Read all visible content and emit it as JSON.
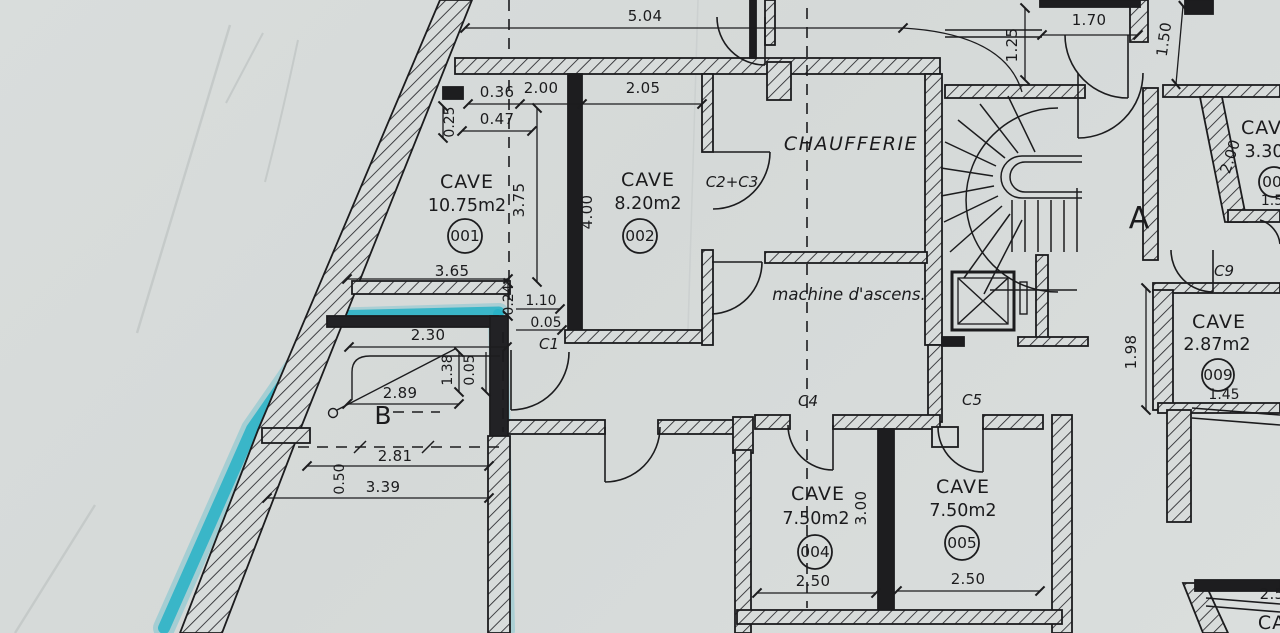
{
  "colors": {
    "paper": "#d7dbda",
    "ink": "#1c1c1e",
    "highlighter": "#27b1c6"
  },
  "rooms": [
    {
      "name": "CAVE",
      "area": "10.75m2",
      "number": "001"
    },
    {
      "name": "CAVE",
      "area": "8.20m2",
      "number": "002"
    },
    {
      "name": "CAVE",
      "area": "7.50m2",
      "number": "004"
    },
    {
      "name": "CAVE",
      "area": "7.50m2",
      "number": "005"
    },
    {
      "name": "CAVE",
      "area": "2.87m2",
      "number": "009"
    },
    {
      "name": "CAVE",
      "area": "3.30",
      "number": "00"
    }
  ],
  "areas": {
    "chaufferie": "CHAUFFERIE",
    "machine_room": "machine d'ascens.",
    "zone_a": "A",
    "zone_b": "B"
  },
  "doors": {
    "c1": "C1",
    "c2c3": "C2+C3",
    "c4": "C4",
    "c5": "C5",
    "c9": "C9"
  },
  "partial": {
    "bottom_right_dim": "2.5",
    "bottom_right_room": "CA"
  },
  "dims": {
    "top_span": "5.04",
    "w036": "0.36",
    "w200": "2.00",
    "w205": "2.05",
    "w047": "0.47",
    "h025": "0.25",
    "h375": "3.75",
    "h400": "4.00",
    "w365": "3.65",
    "h024": "0.24",
    "w110": "1.10",
    "w005": "0.05",
    "w230": "2.30",
    "h138": "1.38",
    "h005": "0.05",
    "w289": "2.89",
    "w281": "2.81",
    "h050": "0.50",
    "w339": "3.39",
    "w170": "1.70",
    "h125": "1.25",
    "h150": "1.50",
    "h200": "2.00",
    "h198": "1.98",
    "w145": "1.45",
    "h15": "1.5",
    "h300": "3.00",
    "w250a": "2.50",
    "w250b": "2.50"
  }
}
